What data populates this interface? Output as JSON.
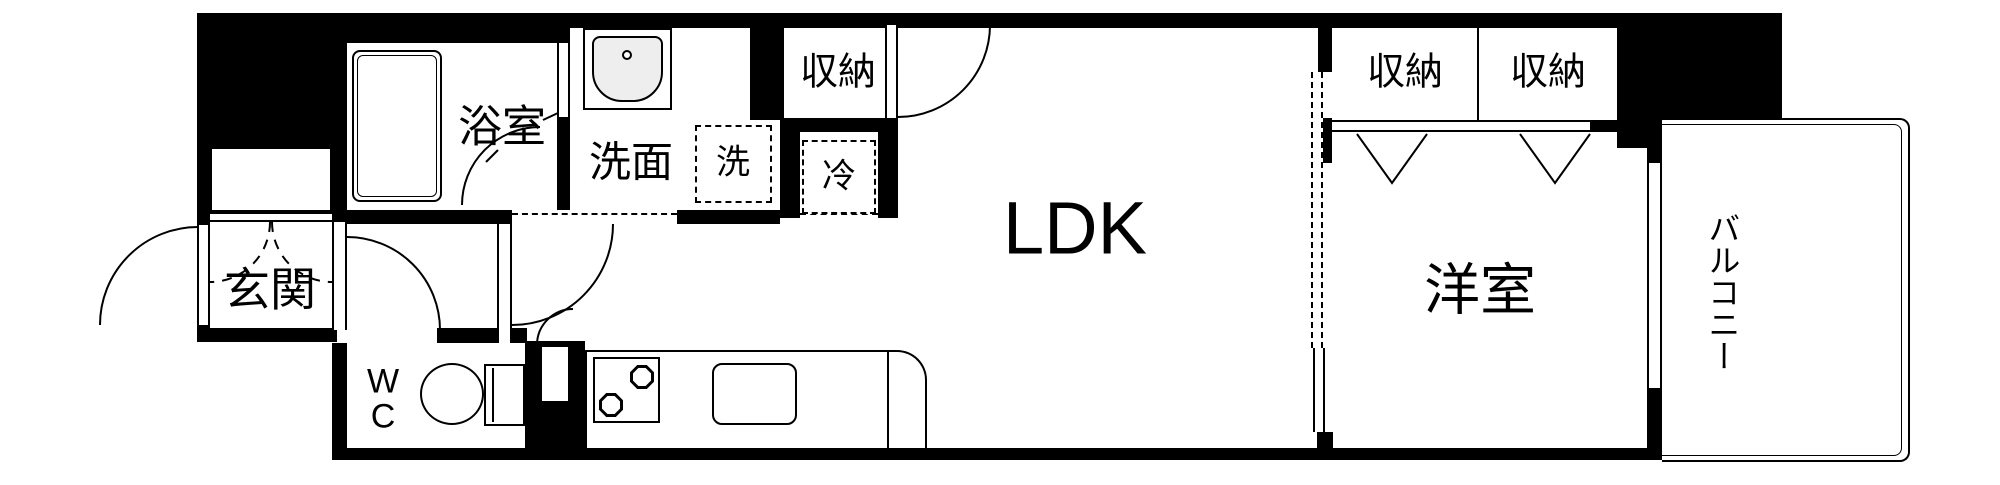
{
  "floorplan": {
    "rooms": {
      "genkan": {
        "label": "玄関"
      },
      "wc": {
        "label_line1": "W",
        "label_line2": "C"
      },
      "bathroom": {
        "label": "浴室"
      },
      "washroom": {
        "label": "洗面"
      },
      "washer_space": {
        "label": "洗"
      },
      "hall_closet": {
        "label": "収納"
      },
      "fridge_space": {
        "label": "冷"
      },
      "ldk": {
        "label": "LDK"
      },
      "closet_a": {
        "label": "収納"
      },
      "closet_b": {
        "label": "収納"
      },
      "western_room": {
        "label": "洋室"
      },
      "balcony": {
        "label": "バルコニー"
      }
    },
    "colors": {
      "wall": "#000000",
      "floor": "#ffffff"
    }
  }
}
